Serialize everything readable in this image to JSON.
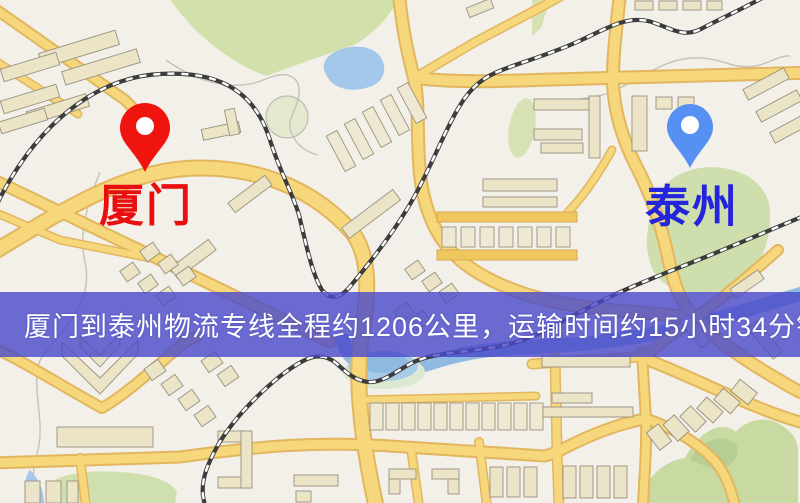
{
  "map": {
    "origin_label": "厦门",
    "destination_label": "泰州",
    "origin_color": "#f0140e",
    "origin_label_color": "#ea0f0f",
    "destination_color": "#5590f2",
    "destination_label_color": "#2424dd"
  },
  "banner": {
    "text": "厦门到泰州物流专线全程约1206公里，运输时间约15小时34分钟.",
    "background": "#4949ca",
    "text_color": "#ffffff"
  }
}
